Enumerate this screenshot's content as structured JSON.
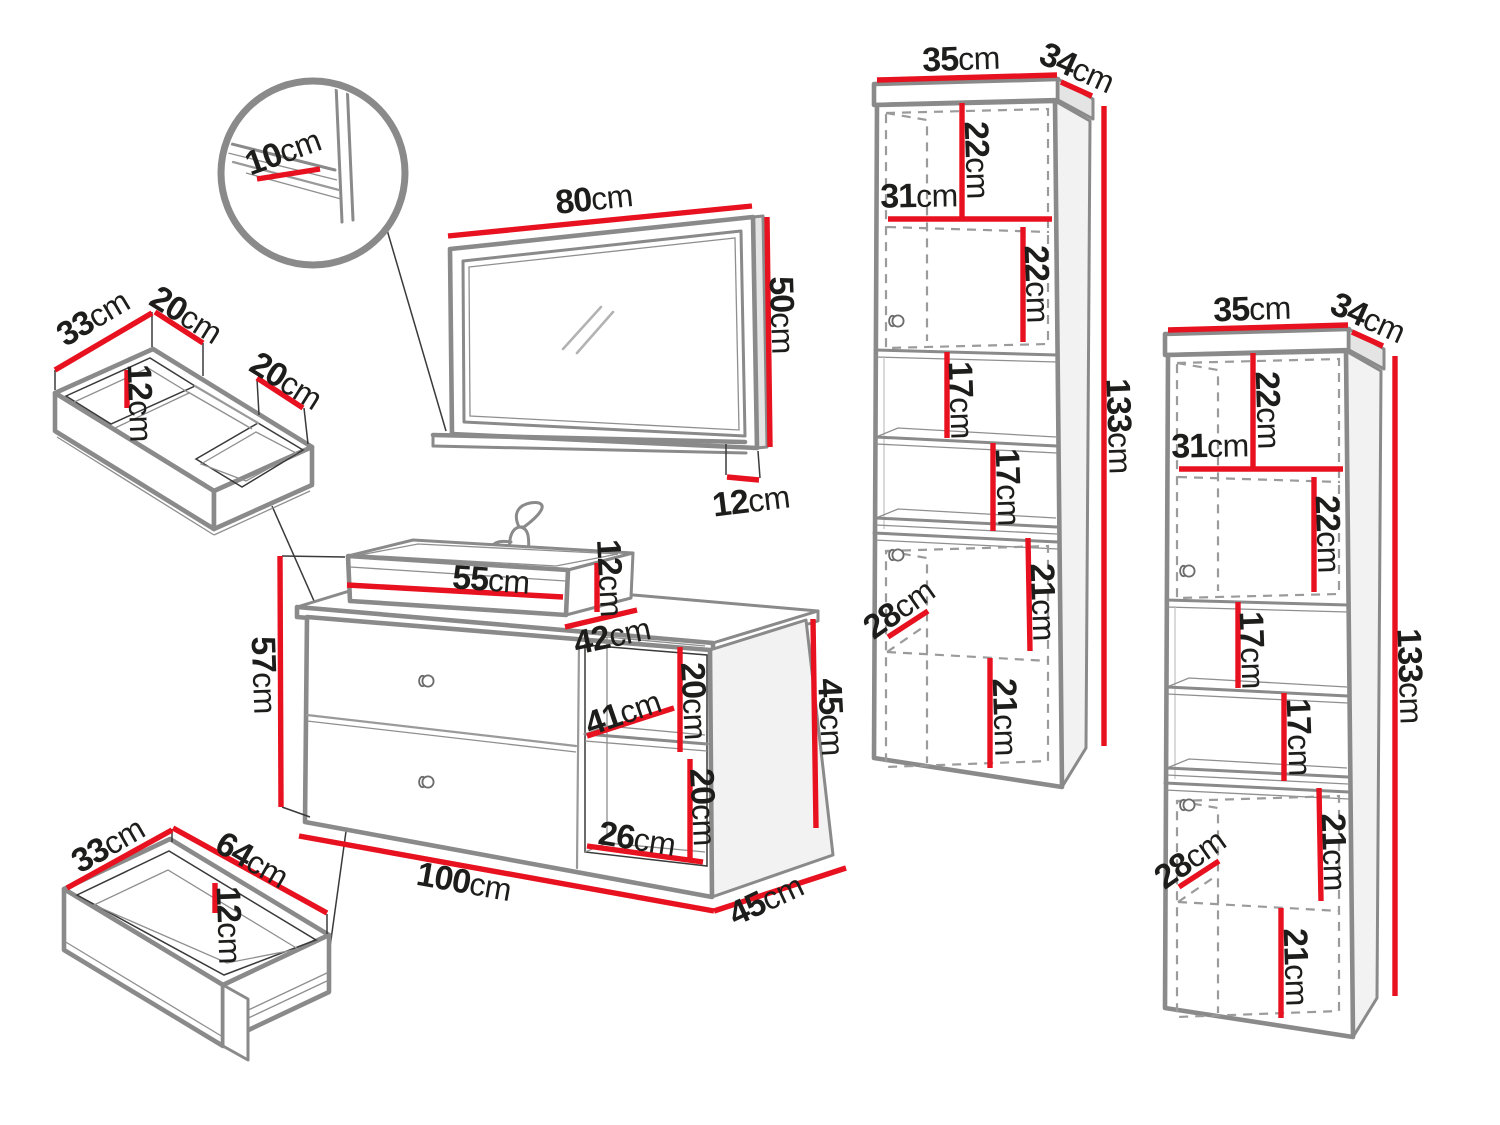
{
  "colors": {
    "dimension_line": "#e8111f",
    "outline": "#8a8a8a",
    "text": "#1d1d1b"
  },
  "detail": {
    "shelf_depth": {
      "v": "10",
      "u": "cm"
    }
  },
  "mirror": {
    "width": {
      "v": "80",
      "u": "cm"
    },
    "height": {
      "v": "50",
      "u": "cm"
    },
    "shelf_depth": {
      "v": "12",
      "u": "cm"
    }
  },
  "corner_drawer": {
    "depth": {
      "v": "33",
      "u": "cm"
    },
    "left_width": {
      "v": "20",
      "u": "cm"
    },
    "height": {
      "v": "12",
      "u": "cm"
    },
    "right_width": {
      "v": "20",
      "u": "cm"
    }
  },
  "drawer": {
    "depth": {
      "v": "33",
      "u": "cm"
    },
    "width": {
      "v": "64",
      "u": "cm"
    },
    "height": {
      "v": "12",
      "u": "cm"
    }
  },
  "vanity": {
    "basin_width": {
      "v": "55",
      "u": "cm"
    },
    "basin_height": {
      "v": "12",
      "u": "cm"
    },
    "basin_depth": {
      "v": "42",
      "u": "cm"
    },
    "total_height": {
      "v": "57",
      "u": "cm"
    },
    "shelf_depth": {
      "v": "41",
      "u": "cm"
    },
    "upper_shelf_height": {
      "v": "20",
      "u": "cm"
    },
    "lower_shelf_height": {
      "v": "20",
      "u": "cm"
    },
    "shelf_width": {
      "v": "26",
      "u": "cm"
    },
    "width": {
      "v": "100",
      "u": "cm"
    },
    "side_height": {
      "v": "45",
      "u": "cm"
    },
    "depth": {
      "v": "45",
      "u": "cm"
    }
  },
  "tall_cabinet_1": {
    "width": {
      "v": "35",
      "u": "cm"
    },
    "depth": {
      "v": "34",
      "u": "cm"
    },
    "top_shelf_height": {
      "v": "22",
      "u": "cm"
    },
    "inner_width": {
      "v": "31",
      "u": "cm"
    },
    "second_shelf_height": {
      "v": "22",
      "u": "cm"
    },
    "open_shelf_height_1": {
      "v": "17",
      "u": "cm"
    },
    "open_shelf_height_2": {
      "v": "17",
      "u": "cm"
    },
    "lower_shelf_height_1": {
      "v": "21",
      "u": "cm"
    },
    "lower_shelf_height_2": {
      "v": "21",
      "u": "cm"
    },
    "lower_shelf_depth": {
      "v": "28",
      "u": "cm"
    },
    "height": {
      "v": "133",
      "u": "cm"
    }
  },
  "tall_cabinet_2": {
    "width": {
      "v": "35",
      "u": "cm"
    },
    "depth": {
      "v": "34",
      "u": "cm"
    },
    "top_shelf_height": {
      "v": "22",
      "u": "cm"
    },
    "inner_width": {
      "v": "31",
      "u": "cm"
    },
    "second_shelf_height": {
      "v": "22",
      "u": "cm"
    },
    "open_shelf_height_1": {
      "v": "17",
      "u": "cm"
    },
    "open_shelf_height_2": {
      "v": "17",
      "u": "cm"
    },
    "lower_shelf_height_1": {
      "v": "21",
      "u": "cm"
    },
    "lower_shelf_height_2": {
      "v": "21",
      "u": "cm"
    },
    "lower_shelf_depth": {
      "v": "28",
      "u": "cm"
    },
    "height": {
      "v": "133",
      "u": "cm"
    }
  }
}
